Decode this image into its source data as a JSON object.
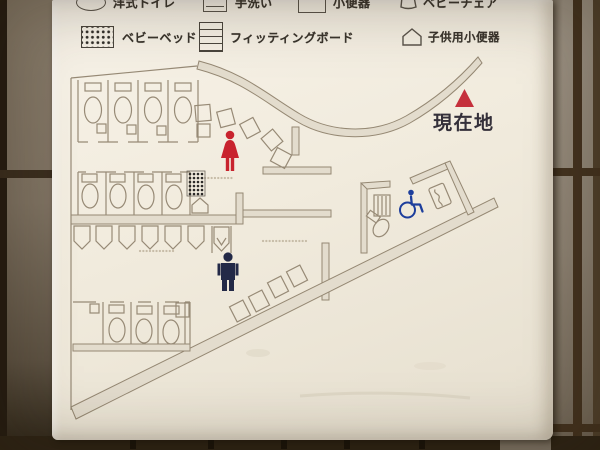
{
  "legend": {
    "row1": [
      {
        "icon": "western-toilet-icon",
        "label": "洋式トイレ"
      },
      {
        "icon": "hand-wash-sink-icon",
        "label": "手洗い"
      },
      {
        "icon": "urinal-icon",
        "label": "小便器"
      },
      {
        "icon": "baby-chair-icon",
        "label": "ベビーチェア"
      }
    ],
    "row2": [
      {
        "icon": "baby-bed-icon",
        "label": "ベビーベッド"
      },
      {
        "icon": "fitting-board-icon",
        "label": "フィッティングボード"
      },
      {
        "icon": "child-urinal-icon",
        "label": "子供用小便器"
      }
    ]
  },
  "map": {
    "you_are_here": {
      "label": "現在地",
      "marker": "red-triangle",
      "marker_color": "#c5303c"
    },
    "pictograms": [
      {
        "name": "woman-pictogram",
        "color": "#c8232e"
      },
      {
        "name": "man-pictogram",
        "color": "#232947"
      },
      {
        "name": "wheelchair-pictogram",
        "color": "#1d3e9c"
      }
    ]
  },
  "colors": {
    "sign_background": "#f3eee2",
    "map_lines": "#978a76",
    "tile_wall": "#857a6a",
    "grout": "#43321f"
  }
}
